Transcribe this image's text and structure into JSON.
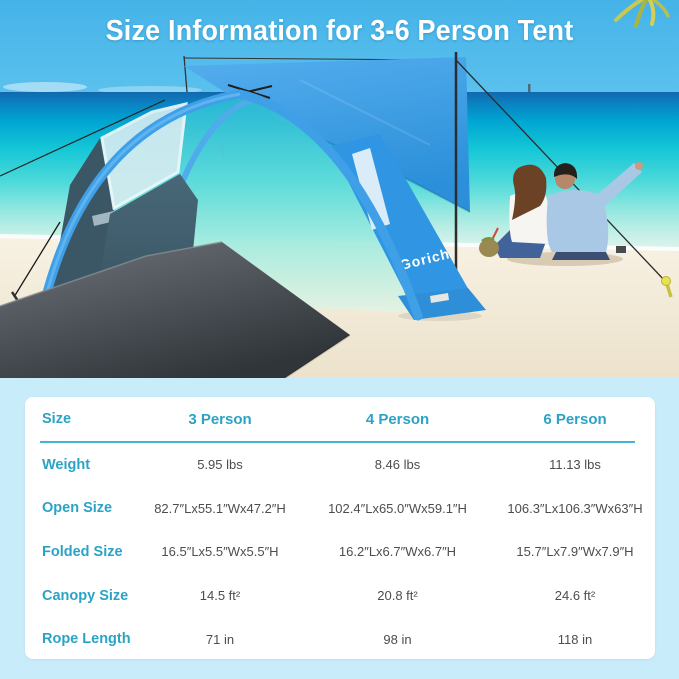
{
  "title": "Size Information for 3-6 Person Tent",
  "photo": {
    "tent_brand": "Gorich"
  },
  "table": {
    "header": {
      "size": "Size",
      "columns": [
        "3 Person",
        "4 Person",
        "6 Person"
      ]
    },
    "rows": [
      {
        "label": "Weight",
        "values": [
          "5.95 lbs",
          "8.46 lbs",
          "11.13 lbs"
        ]
      },
      {
        "label": "Open Size",
        "values": [
          "82.7″Lx55.1″Wx47.2″H",
          "102.4″Lx65.0″Wx59.1″H",
          "106.3″Lx106.3″Wx63″H"
        ]
      },
      {
        "label": "Folded Size",
        "values": [
          "16.5″Lx5.5″Wx5.5″H",
          "16.2″Lx6.7″Wx6.7″H",
          "15.7″Lx7.9″Wx7.9″H"
        ]
      },
      {
        "label": "Canopy Size",
        "values": [
          "14.5 ft²",
          "20.8 ft²",
          "24.6 ft²"
        ]
      },
      {
        "label": "Rope Length",
        "values": [
          "71 in",
          "98 in",
          "118 in"
        ]
      }
    ]
  },
  "colors": {
    "accent_teal": "#2ba3c5",
    "divider_teal": "#45b5d6",
    "value_text": "#4d4d4d",
    "page_bg": "#c9ecfb",
    "sky_blue": "#48b6e9",
    "tent_blue": "#3b9fe6",
    "card_bg": "#ffffff"
  }
}
